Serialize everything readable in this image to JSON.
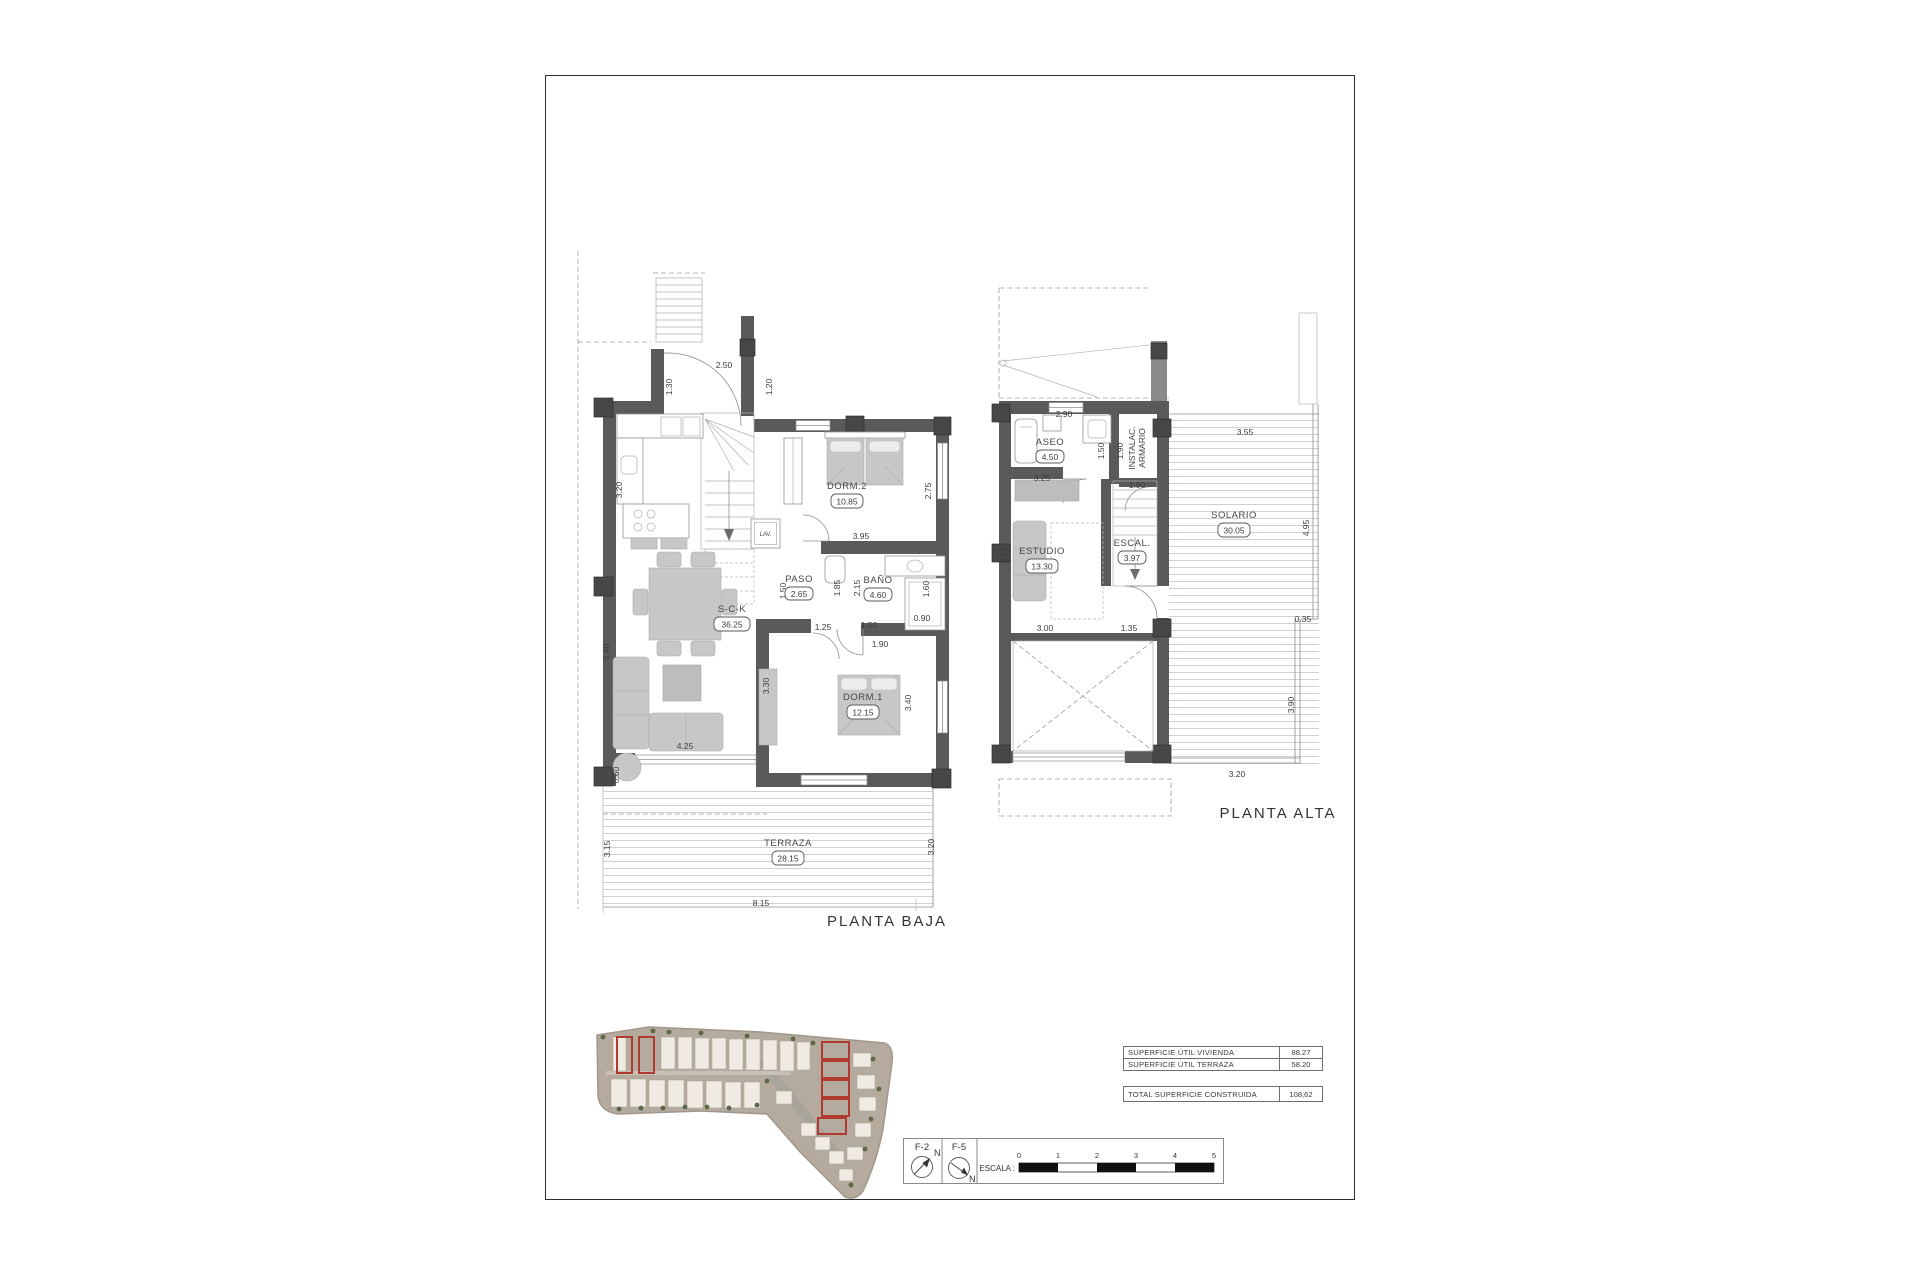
{
  "plans": {
    "baja": {
      "title": "PLANTA BAJA",
      "rooms": {
        "sck": {
          "name": "S-C-K",
          "area": "36.25"
        },
        "paso": {
          "name": "PASO",
          "area": "2.65"
        },
        "bano": {
          "name": "BAÑO",
          "area": "4.60"
        },
        "dorm1": {
          "name": "DORM.1",
          "area": "12.15"
        },
        "dorm2": {
          "name": "DORM.2",
          "area": "10.85"
        },
        "terraza": {
          "name": "TERRAZA",
          "area": "28.15"
        }
      },
      "lav": "LAV.",
      "dims": [
        "2.50",
        "1.30",
        "1.20",
        "3.20",
        "5.40",
        "0.60",
        "3.15",
        "3.20",
        "8.15",
        "4.25",
        "3.30",
        "1.25",
        "3.95",
        "2.75",
        "1.50",
        "1.85",
        "2.15",
        "1.50",
        "1.90",
        "1.60",
        "0.90",
        "3.40"
      ]
    },
    "alta": {
      "title": "PLANTA ALTA",
      "rooms": {
        "aseo": {
          "name": "ASEO",
          "area": "4.50"
        },
        "estudio": {
          "name": "ESTUDIO",
          "area": "13.30"
        },
        "escal": {
          "name": "ESCAL.",
          "area": "3.97"
        },
        "solario": {
          "name": "SOLARIO",
          "area": "30.05"
        }
      },
      "closet_line1": "INSTALAC.",
      "closet_line2": "ARMARIO",
      "dims": [
        "2.90",
        "1.50",
        "1.90",
        "1.00",
        "3.25",
        "4.10",
        "3.00",
        "1.35",
        "3.55",
        "4.95",
        "0.35",
        "3.90",
        "3.20"
      ]
    }
  },
  "surface_table": {
    "rows": [
      {
        "label": "SUPERFICIE ÚTIL VIVIENDA",
        "value": "88.27"
      },
      {
        "label": "SUPERFICIE ÚTIL TERRAZA",
        "value": "58.20"
      }
    ],
    "total": {
      "label": "TOTAL SUPERFICIE CONSTRUIDA",
      "value": "108,62"
    }
  },
  "legend": {
    "compass_1": "F-2",
    "compass_2": "F-5",
    "north": "N",
    "scale_label": "ESCALA :",
    "scale_ticks": [
      "0",
      "1",
      "2",
      "3",
      "4",
      "5"
    ]
  },
  "colors": {
    "wall": "#5a5a5a",
    "highlight_red": "#b03a30",
    "site_ground": "#b4aa9d"
  }
}
